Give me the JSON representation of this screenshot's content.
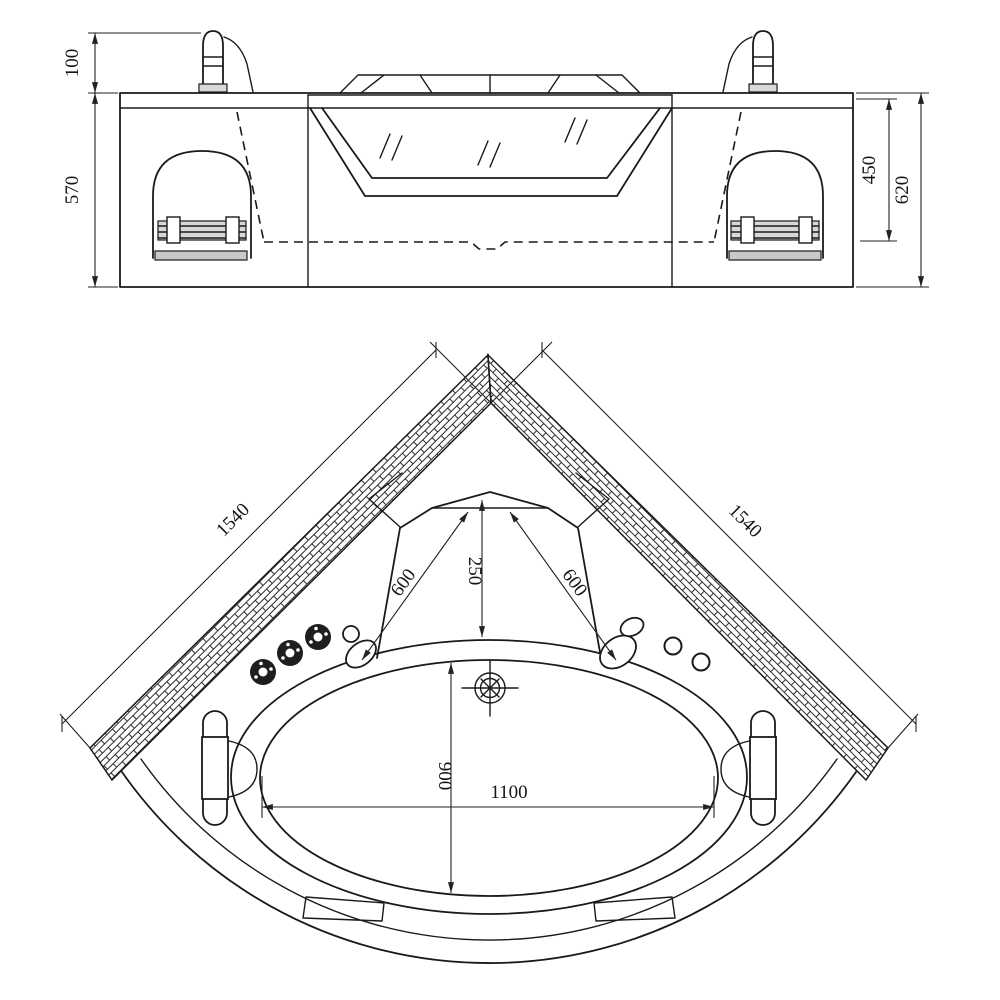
{
  "drawing": {
    "front_view": {
      "dim_faucet_height": "100",
      "dim_body_height": "570",
      "dim_basin_depth": "450",
      "dim_overall_height": "620"
    },
    "plan_view": {
      "dim_left_wall": "1540",
      "dim_right_wall": "1540",
      "dim_backrest_depth": "250",
      "dim_corner_left": "600",
      "dim_corner_right": "600",
      "dim_well_length": "900",
      "dim_well_width": "1100"
    }
  }
}
